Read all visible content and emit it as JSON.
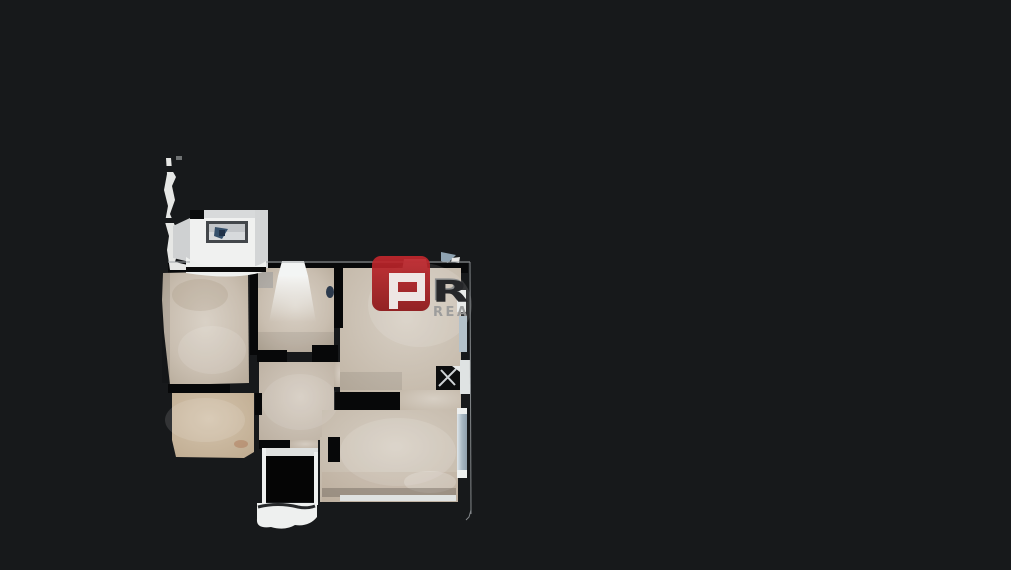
{
  "viewer": {
    "background_color": "#17191b"
  },
  "watermark": {
    "emblem_letter": "P",
    "emblem_bg_color": "#a7191e",
    "name_visible_letter": "R",
    "name_color": "#26272a",
    "name_highlight_color": "#84878a",
    "subtitle_visible": "REA",
    "subtitle_color": "#9b9b9b"
  },
  "floorplan": {
    "floor_color": "#c7bcae",
    "floor_warm_color": "#c9b8a1",
    "wall_gap_color": "#070809",
    "outline_color": "#9fa3a6",
    "white_wall_color": "#eef0ef",
    "window_tint_color": "#b3c1ca",
    "desk_surface_color": "#c3c6c9",
    "desk_item_color": "#35506b"
  }
}
